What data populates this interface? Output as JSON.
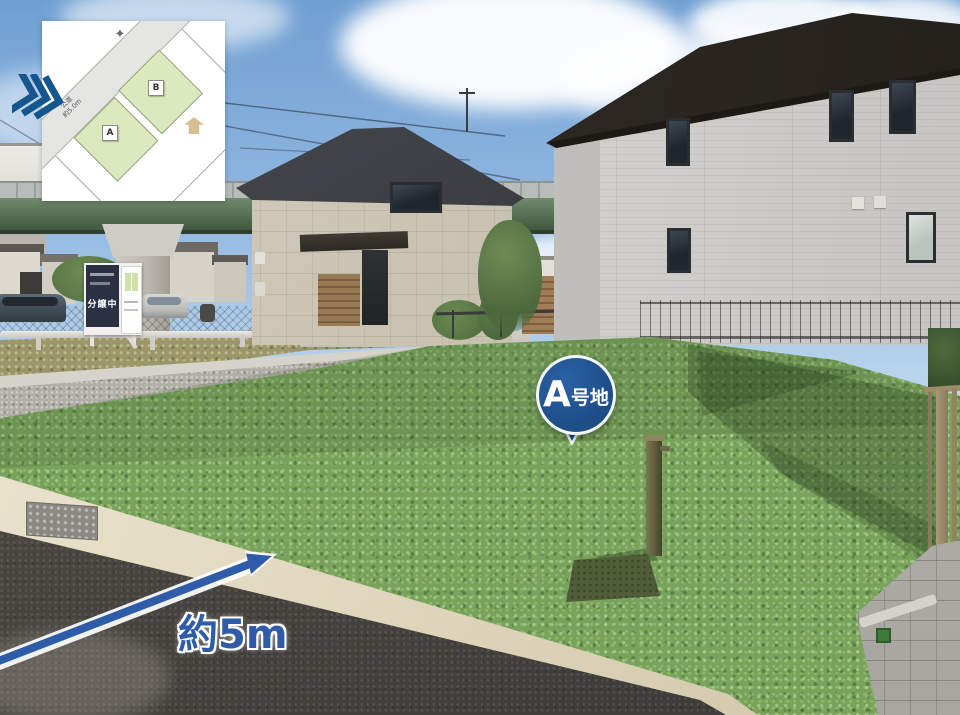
{
  "annotations": {
    "plot_marker": {
      "label_main": "A",
      "label_sub": "号地",
      "bg_color": "#1d4e88"
    },
    "width_arrow": {
      "label": "約5m",
      "color": "#2e5ca9"
    },
    "direction_chevrons": {
      "count": 3,
      "color": "#15568f"
    }
  },
  "inset_map": {
    "plot_labels": {
      "a": "A",
      "b": "B"
    },
    "road_label_line1": "公道",
    "road_label_line2": "約5.0m",
    "icons": [
      "compass-icon",
      "house-icon"
    ],
    "colors": {
      "plot_fill": "#dce8bd",
      "road_fill": "#e4e4e3",
      "house_icon": "#d8bf92"
    }
  },
  "scene": {
    "signboard_text": "分譲中",
    "colors": {
      "lot_overlay_green": "#79a35c",
      "sky_top": "#6f9fd2",
      "asphalt": "#4c4946",
      "curb": "#e7dfc9",
      "viaduct_green": "#55704f",
      "marker_blue": "#1d4e88"
    }
  }
}
